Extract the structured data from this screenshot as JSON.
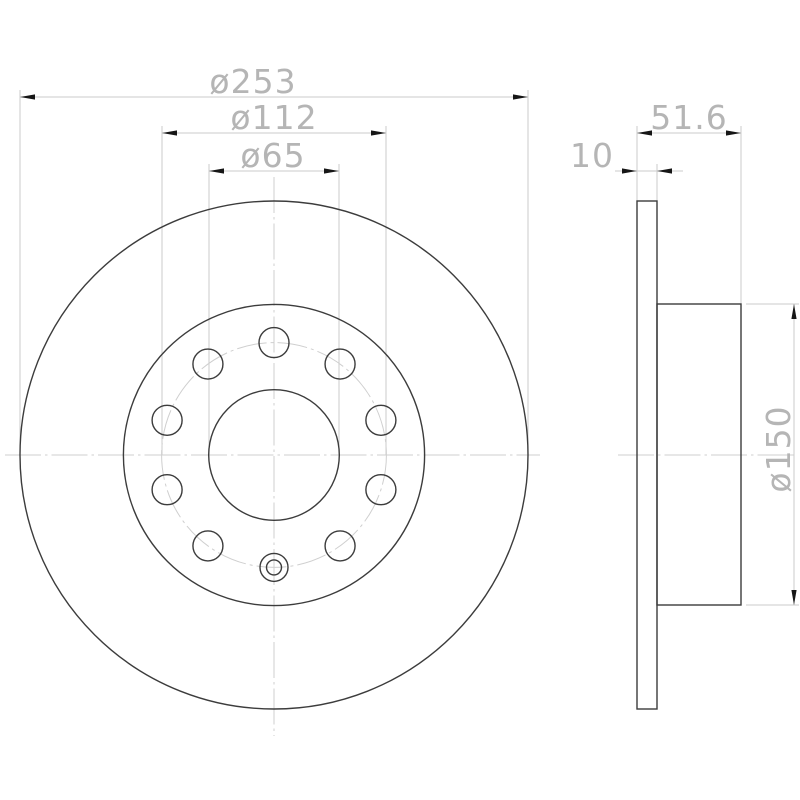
{
  "drawing": {
    "kind": "brake-disc-technical-drawing",
    "units": "mm",
    "front_view": {
      "center": {
        "x": 274,
        "y": 455
      },
      "circles": [
        {
          "id": "outer-circle",
          "label": "ø253",
          "value_mm": 253,
          "radius_px": 254,
          "style": "solid"
        },
        {
          "id": "hat-circle",
          "label": "ø150",
          "value_mm": 150,
          "radius_px": 150.6,
          "style": "solid"
        },
        {
          "id": "bolt-circle",
          "label": "ø112",
          "value_mm": 112,
          "radius_px": 112.4,
          "style": "centerline"
        },
        {
          "id": "center-bore",
          "label": "ø65",
          "value_mm": 65,
          "radius_px": 65.3,
          "style": "solid"
        }
      ],
      "bolt_holes": {
        "pitch_radius_px": 112.4,
        "hole_radius_px": 15,
        "angles_deg": [
          -90,
          -54,
          -18,
          18,
          54,
          126,
          162,
          198,
          234
        ]
      },
      "locating_hole": {
        "angle_deg": 90,
        "outer_radius_px": 14,
        "inner_radius_px": 7.5
      },
      "centerlines": [
        {
          "id": "front-horizontal-centerline",
          "x1": 5,
          "y1": 455,
          "x2": 540,
          "y2": 455
        },
        {
          "id": "front-vertical-centerline",
          "x1": 274,
          "y1": 177,
          "x2": 274,
          "y2": 736
        }
      ],
      "dimensions": [
        {
          "id": "dim-outer-diameter",
          "label": "ø253",
          "value_mm": 253,
          "line": {
            "y": 97,
            "x1": 20,
            "x2": 528
          },
          "ext": [
            {
              "x": 20,
              "y1": 90,
              "y2": 455
            },
            {
              "x": 528,
              "y1": 90,
              "y2": 455
            }
          ],
          "arrows": [
            {
              "x": 20,
              "y": 97,
              "dir": "left"
            },
            {
              "x": 528,
              "y": 97,
              "dir": "right"
            }
          ],
          "text": {
            "x": 253,
            "y": 93
          }
        },
        {
          "id": "dim-bolt-circle-diameter",
          "label": "ø112",
          "value_mm": 112,
          "line": {
            "y": 133,
            "x1": 162,
            "x2": 386
          },
          "ext": [
            {
              "x": 162,
              "y1": 126,
              "y2": 455
            },
            {
              "x": 386,
              "y1": 126,
              "y2": 455
            }
          ],
          "arrows": [
            {
              "x": 162,
              "y": 133,
              "dir": "left"
            },
            {
              "x": 386,
              "y": 133,
              "dir": "right"
            }
          ],
          "text": {
            "x": 274,
            "y": 129
          }
        },
        {
          "id": "dim-center-bore-diameter",
          "label": "ø65",
          "value_mm": 65,
          "line": {
            "y": 171,
            "x1": 209,
            "x2": 339
          },
          "ext": [
            {
              "x": 209,
              "y1": 164,
              "y2": 455
            },
            {
              "x": 339,
              "y1": 164,
              "y2": 455
            }
          ],
          "arrows": [
            {
              "x": 209,
              "y": 171,
              "dir": "left"
            },
            {
              "x": 339,
              "y": 171,
              "dir": "right"
            }
          ],
          "text": {
            "x": 273,
            "y": 167
          }
        }
      ]
    },
    "side_view": {
      "plate": {
        "x1": 637,
        "x2": 657,
        "y1": 201,
        "y2": 709
      },
      "hat": {
        "x1": 657,
        "x2": 741,
        "y1": 304,
        "y2": 605
      },
      "centerlines": [
        {
          "id": "side-horizontal-centerline",
          "x1": 618,
          "y1": 455,
          "x2": 797,
          "y2": 455
        }
      ],
      "dimensions": [
        {
          "id": "dim-overall-width",
          "label": "51.6",
          "value_mm": 51.6,
          "line": {
            "y": 133,
            "x1": 637,
            "x2": 741
          },
          "ext": [
            {
              "x": 637,
              "y1": 126,
              "y2": 201
            },
            {
              "x": 741,
              "y1": 126,
              "y2": 304
            }
          ],
          "arrows": [
            {
              "x": 637,
              "y": 133,
              "dir": "left"
            },
            {
              "x": 741,
              "y": 133,
              "dir": "right"
            }
          ],
          "text": {
            "x": 689,
            "y": 129
          }
        },
        {
          "id": "dim-plate-thickness",
          "label": "10",
          "value_mm": 10,
          "line": {
            "y": 171,
            "x1": 615,
            "x2": 683
          },
          "ext": [
            {
              "x": 657,
              "y1": 164,
              "y2": 201
            }
          ],
          "arrows": [
            {
              "x": 637,
              "y": 171,
              "dir": "right"
            },
            {
              "x": 657,
              "y": 171,
              "dir": "left"
            }
          ],
          "text": {
            "x": 592,
            "y": 167
          }
        },
        {
          "id": "dim-hat-diameter",
          "label": "ø150",
          "value_mm": 150,
          "vertical": true,
          "line": {
            "x": 794,
            "y1": 304,
            "y2": 605
          },
          "ext": [
            {
              "y": 304,
              "x1": 746,
              "x2": 799
            },
            {
              "y": 605,
              "x1": 746,
              "x2": 799
            }
          ],
          "arrows": [
            {
              "x": 794,
              "y": 304,
              "dir": "up"
            },
            {
              "x": 794,
              "y": 605,
              "dir": "down"
            }
          ],
          "text": {
            "x": 790,
            "y": 449,
            "rotate": -90
          }
        }
      ]
    }
  },
  "colors": {
    "background": "#ffffff",
    "geometry": "#3c3c3c",
    "light_line": "#cbcbcb",
    "centerline": "#cfcfcf",
    "dimension_text": "#b5b5b5",
    "arrow": "#161616"
  }
}
